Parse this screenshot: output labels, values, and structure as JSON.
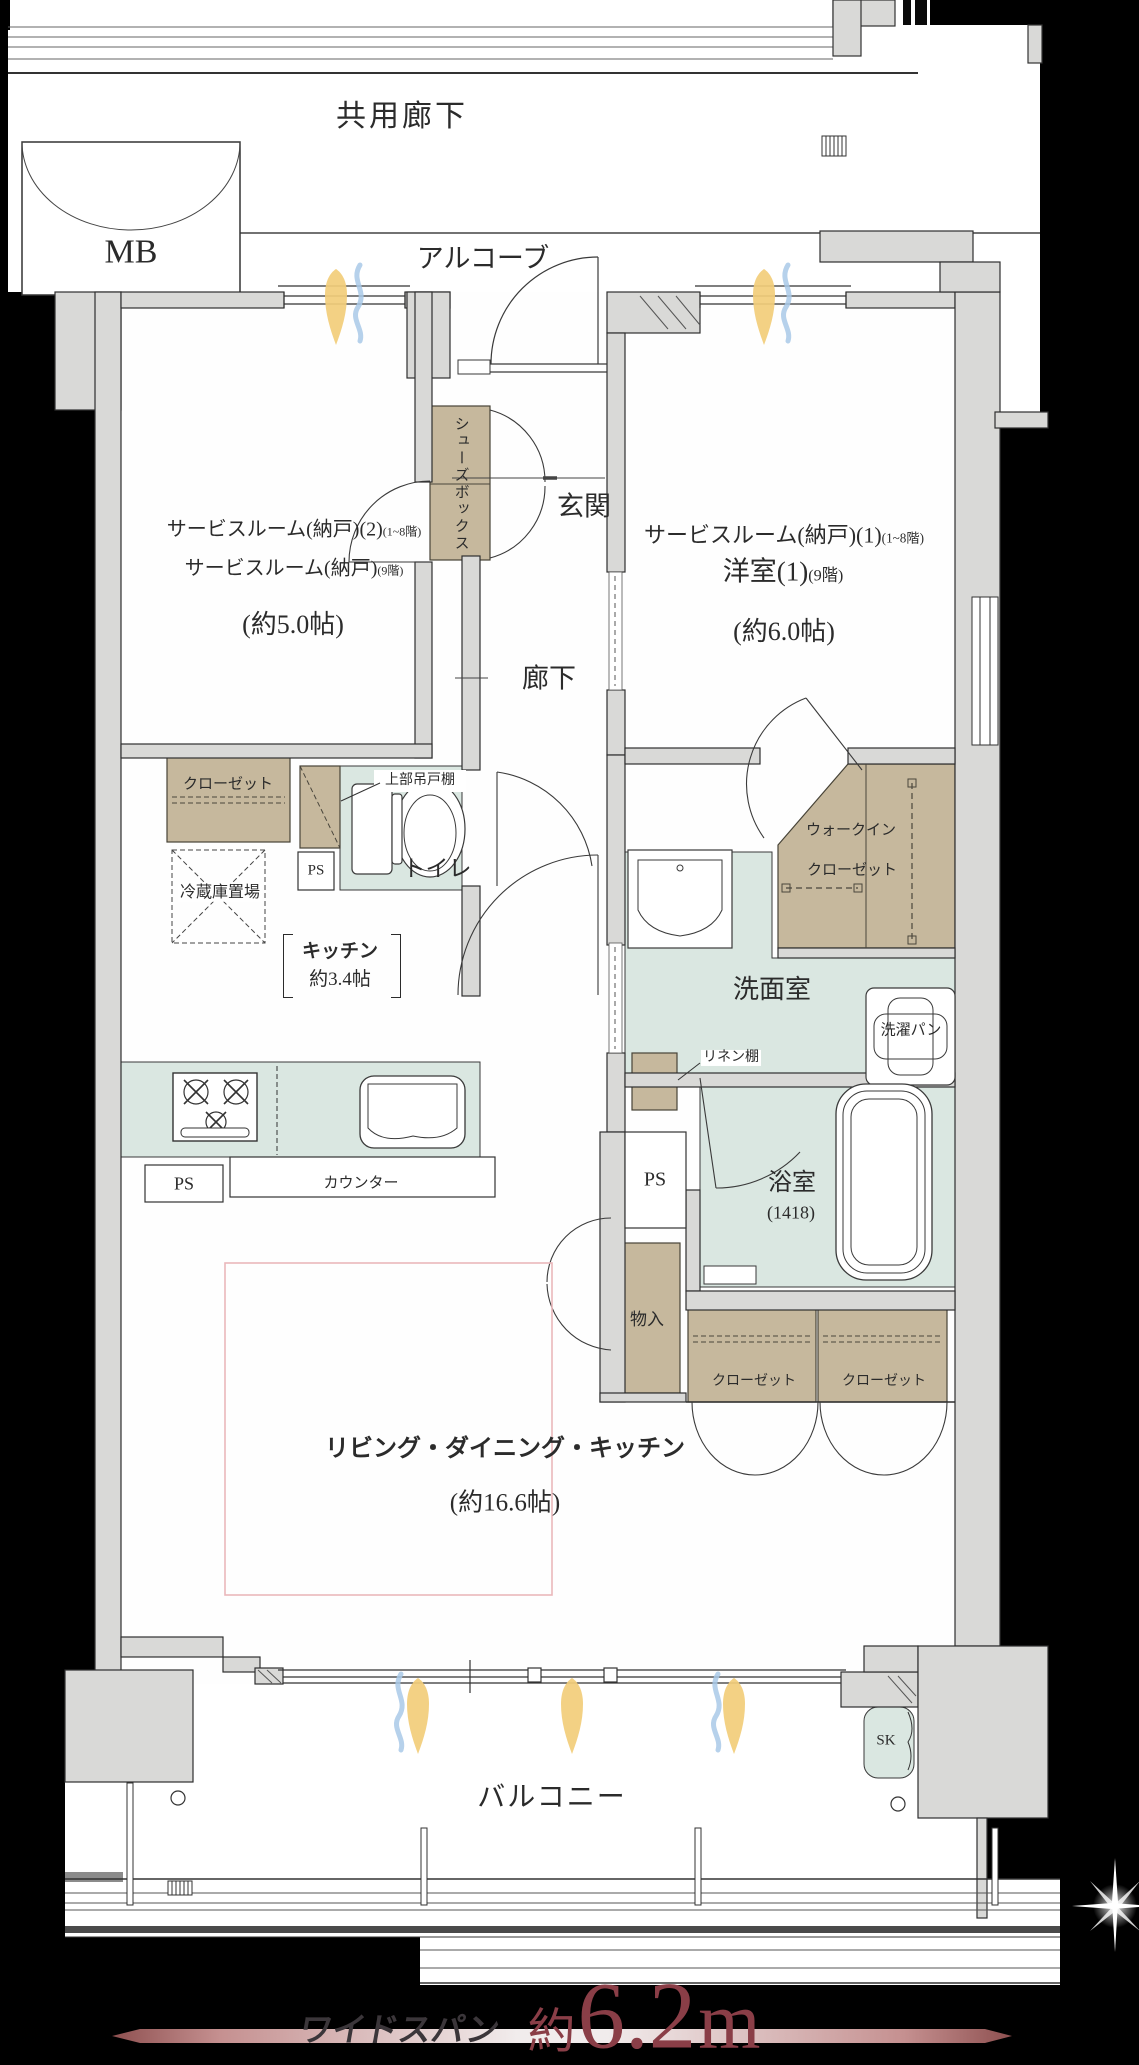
{
  "common": {
    "shared_corridor": "共用廊下",
    "meter_box": "MB",
    "alcove": "アルコーブ",
    "balcony": "バルコニー"
  },
  "rooms": {
    "service2": {
      "line1": "サービスルーム(納戸)(2)",
      "line1_floors": "(1~8階)",
      "line2": "サービスルーム(納戸)",
      "line2_floors": "(9階)",
      "size": "(約5.0帖)"
    },
    "service1": {
      "line1": "サービスルーム(納戸)(1)",
      "line1_floors": "(1~8階)",
      "line2": "洋室(1)",
      "line2_floors": "(9階)",
      "size": "(約6.0帖)"
    },
    "entrance": "玄関",
    "hallway": "廊下",
    "toilet": "トイレ",
    "washroom": "洗面室",
    "bathroom": {
      "name": "浴室",
      "size": "(1418)"
    },
    "kitchen": {
      "name": "キッチン",
      "size": "約3.4帖"
    },
    "ldk": {
      "name": "リビング・ダイニング・キッチン",
      "size": "(約16.6帖)"
    }
  },
  "storage": {
    "shoes_box": "シューズボックス",
    "closet": "クローゼット",
    "walk_in_line1": "ウォークイン",
    "walk_in_line2": "クローゼット",
    "storage_compartment": "物入",
    "linen_shelf": "リネン棚"
  },
  "fixtures": {
    "upper_hanging_cabinet": "上部吊戸棚",
    "refrigerator_space": "冷蔵庫置場",
    "counter": "カウンター",
    "laundry_pan": "洗濯パン",
    "slop_sink": "SK",
    "pipe_space": "PS"
  },
  "dimension": {
    "label": "ワイドスパン",
    "prefix": "約",
    "value": "6.2",
    "unit": "m"
  },
  "colors": {
    "wall": "#d9d9d7",
    "wet_area": "#dae7e1",
    "storage_tan": "#c6b89d",
    "accent_red": "#8a3e47",
    "ldk_outline_pink": "#e9b7bb",
    "flame_yellow": "#f2cd79",
    "airflow_blue": "#a9c9e8",
    "background": "#000000"
  }
}
